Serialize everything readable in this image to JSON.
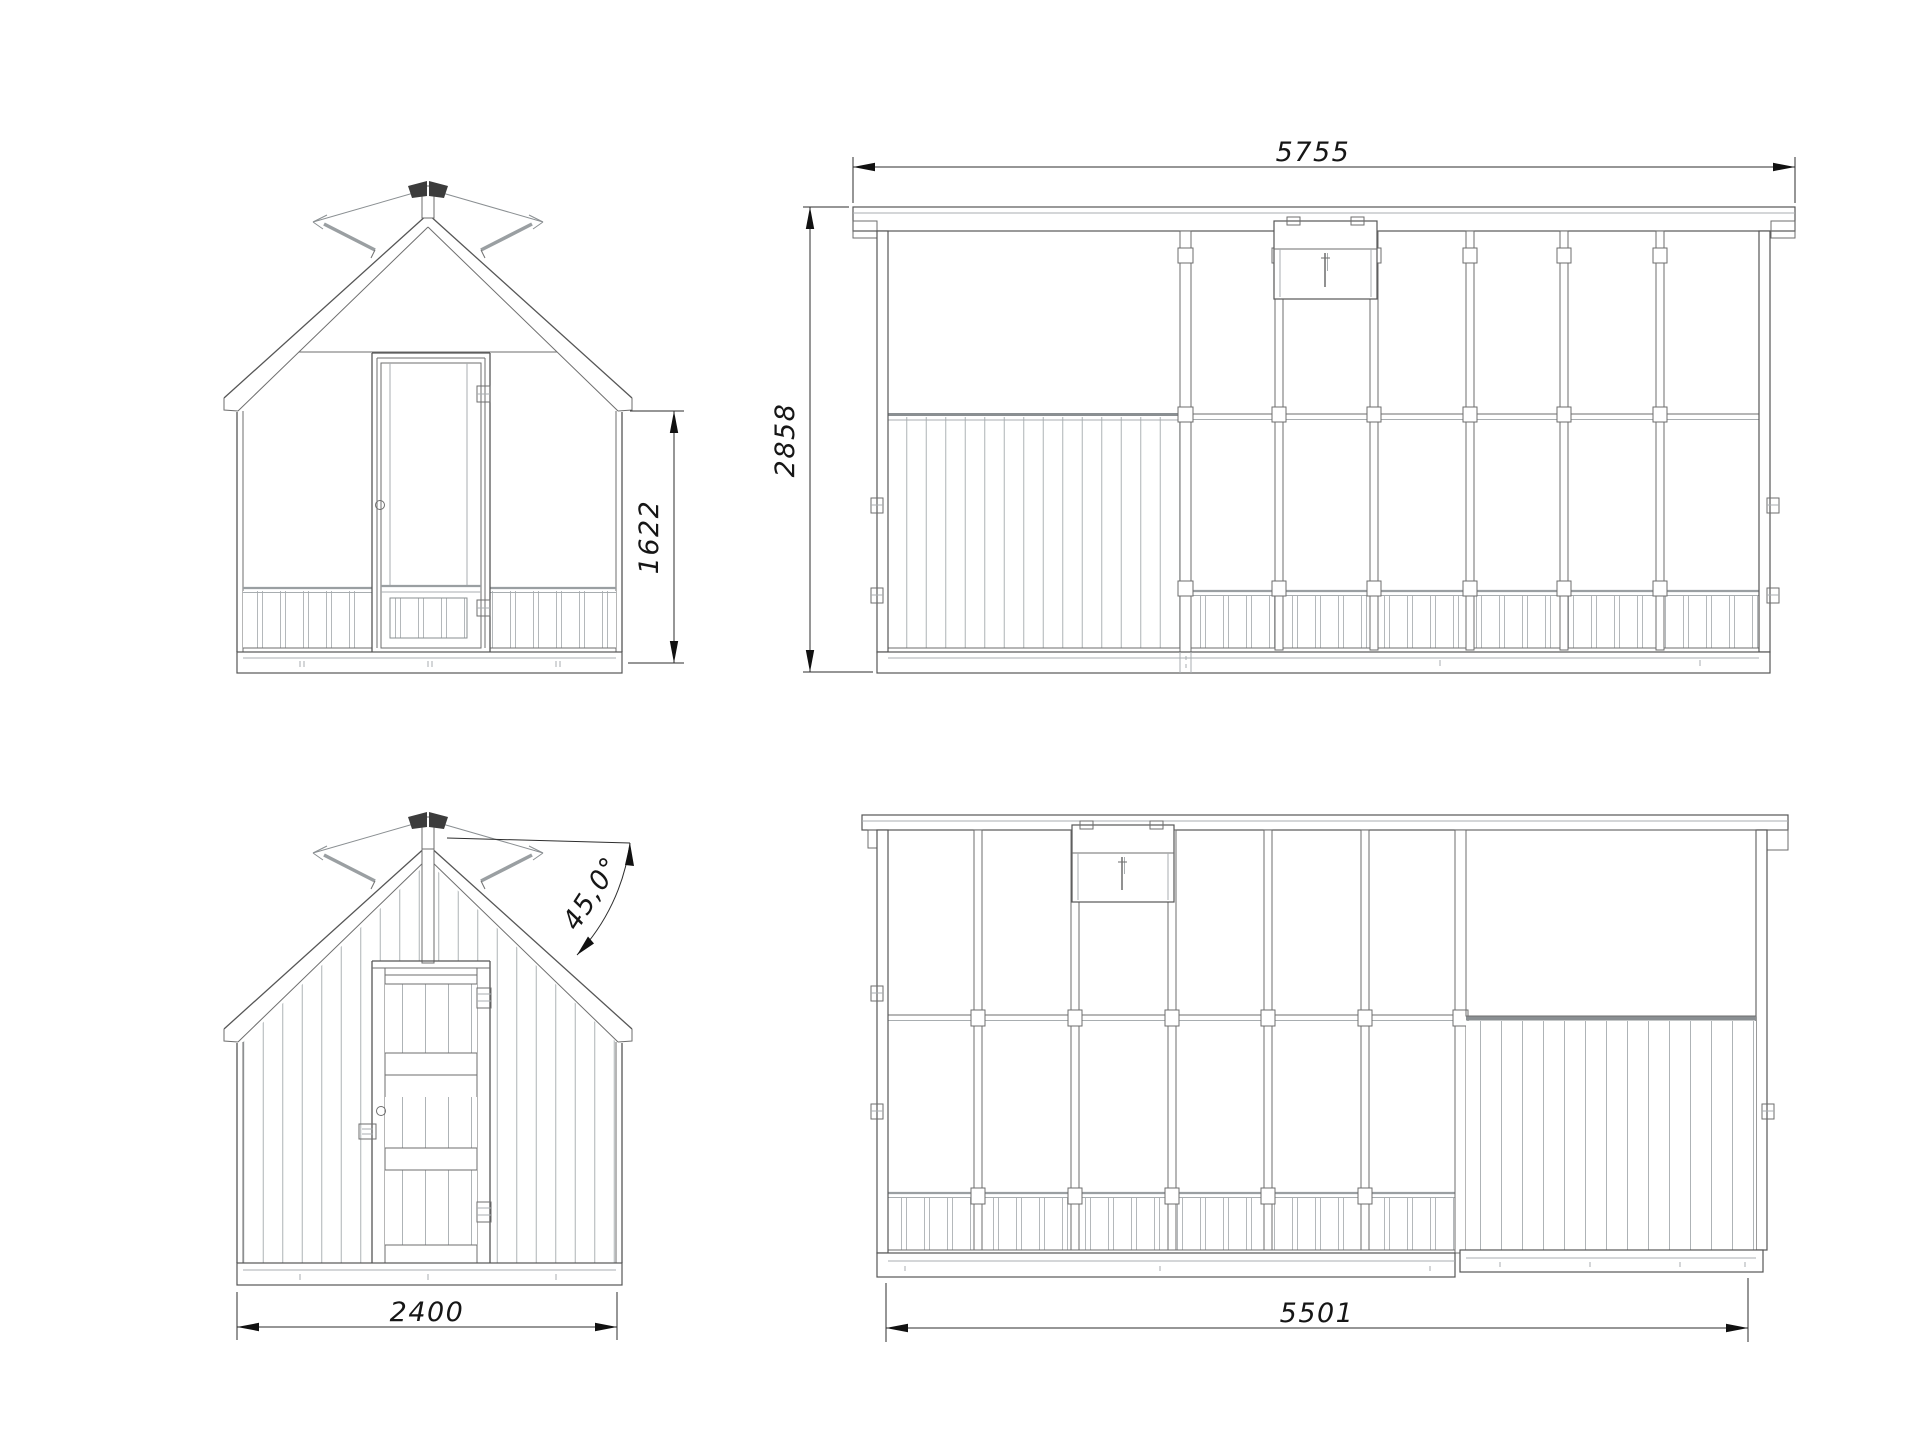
{
  "drawing": {
    "type": "technical-elevation-drawing",
    "subject": "garden greenhouse with shed section, four orthographic views",
    "background": "#ffffff",
    "line_color": "#565656",
    "accent_text_color": "#161616"
  },
  "views": {
    "front_elevation": {
      "position": "top-left",
      "features": [
        "gable roof with ornamental finial",
        "central glazed door",
        "slatted kickboard panels"
      ]
    },
    "long_side_elevation": {
      "position": "top-right",
      "features": [
        "roof vent window",
        "six glazed bays with mullions",
        "vertically planked shed section",
        "slatted kickboards"
      ]
    },
    "rear_elevation": {
      "position": "bottom-left",
      "features": [
        "fully planked wall and gable",
        "ledged plank door with hinges and lock",
        "roof pitch callout"
      ]
    },
    "opposite_side_elevation": {
      "position": "bottom-right",
      "features": [
        "roof vent window",
        "six glazed bays",
        "mid-height transom",
        "planked shed section"
      ]
    }
  },
  "dimensions": {
    "side_length": "5755",
    "overall_height": "2858",
    "front_wall_height": "1622",
    "front_width": "2400",
    "roof_pitch": "45,0°",
    "base_length": "5501"
  }
}
